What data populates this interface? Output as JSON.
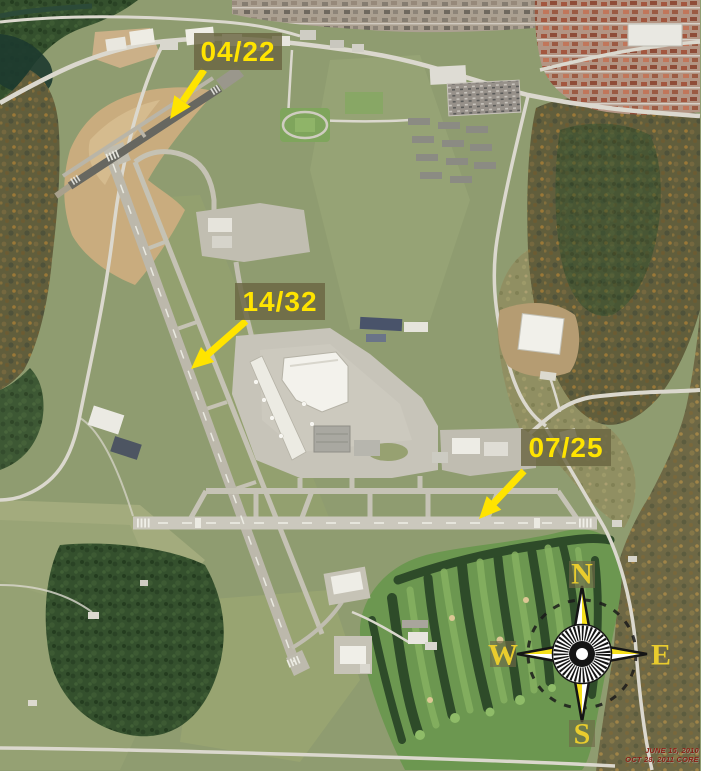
{
  "scene": {
    "type": "aerial-photograph",
    "subject": "Airport aerial view with three annotated runways, terminal complex, golf course, forests and suburbs"
  },
  "annotations": {
    "runway_labels": [
      {
        "id": "runway-04-22",
        "text": "04/22"
      },
      {
        "id": "runway-14-32",
        "text": "14/32"
      },
      {
        "id": "runway-07-25",
        "text": "07/25"
      }
    ],
    "label_text_color": "#ffe400",
    "label_box_color": "rgba(106,101,66,0.82)",
    "arrow_color": "#ffe400"
  },
  "compass_rose": {
    "cardinal_labels": {
      "north": "N",
      "east": "E",
      "south": "S",
      "west": "W"
    },
    "letter_color": "#e9cc2e",
    "star_yellow": "#f7e11c",
    "star_white": "#ffffff",
    "outline_color": "#151515"
  },
  "imagery_date_stamp": {
    "line1": "JUNE 15, 2010",
    "line2": "OCT 28, 2011 CORE",
    "text_color": "#8a2015"
  }
}
